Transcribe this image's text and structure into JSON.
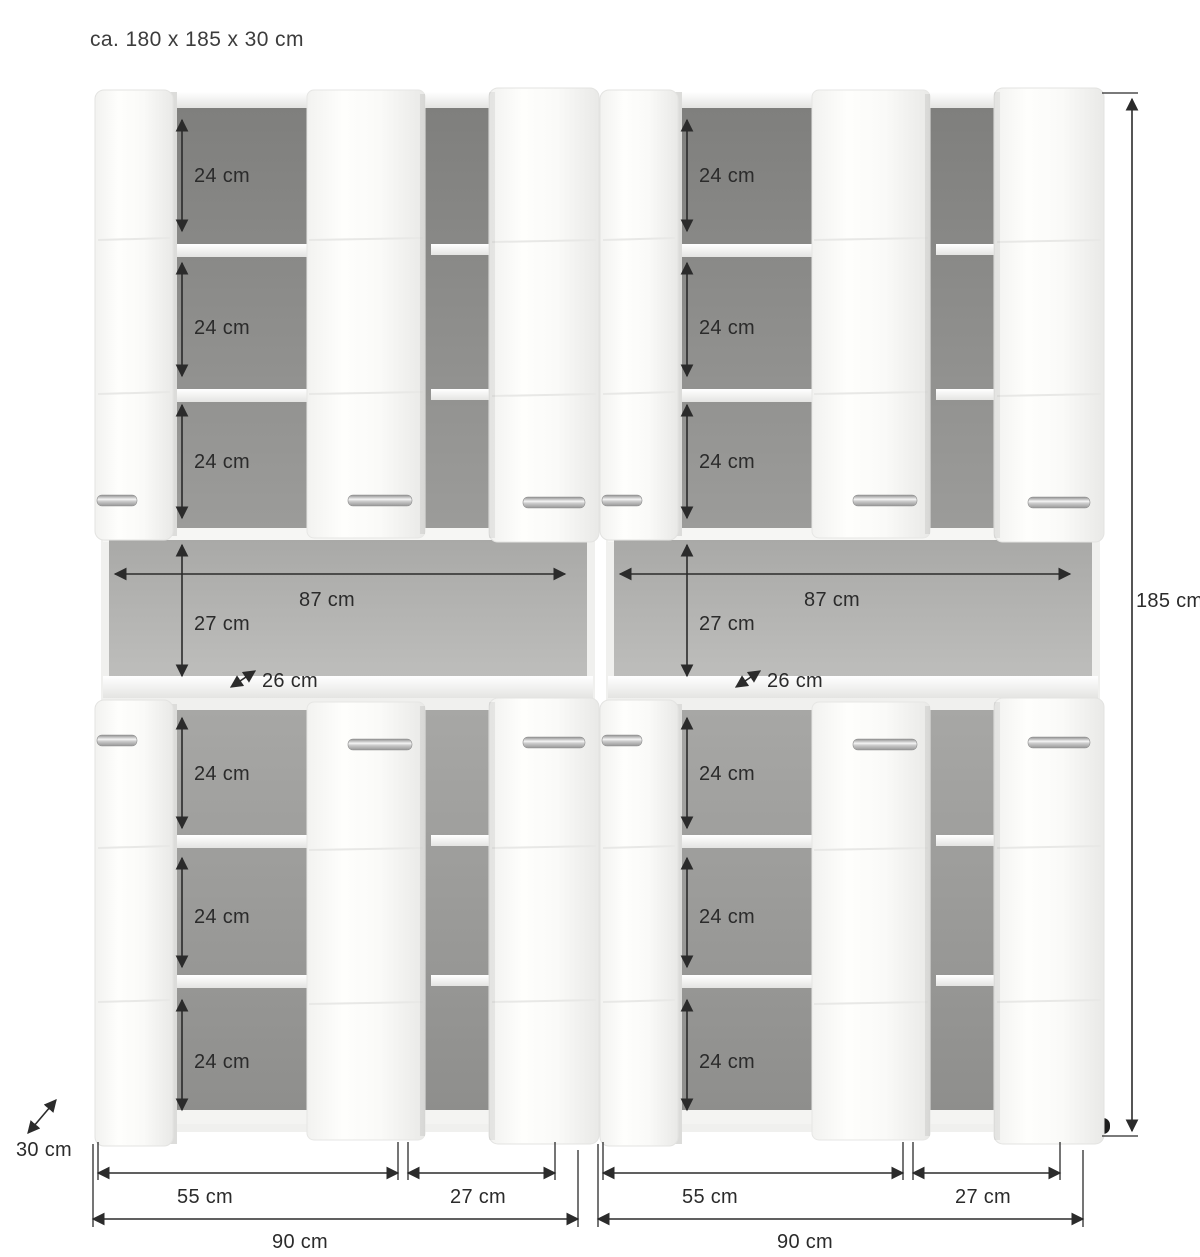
{
  "title": "ca. 180 x 185 x 30 cm",
  "dimensions": {
    "compartment_height": "24 cm",
    "niche_width": "87 cm",
    "niche_height": "27 cm",
    "niche_depth": "26 cm",
    "door_section_width": "55 cm",
    "side_section_width": "27 cm",
    "unit_width": "90 cm",
    "overall_height": "185 cm",
    "overall_depth": "30 cm"
  },
  "colors": {
    "background": "#ffffff",
    "dimension_ink": "#2b2b2b",
    "cabinet_white": "#f0f0ee",
    "door_white": "#fdfdfb",
    "interior_gray_top": "#8c8c8a",
    "interior_gray_bottom": "#9e9e9c",
    "niche_gray": "#b4b4b2",
    "shelf_white": "#f4f4f2",
    "handle_chrome": "#d6d6d4",
    "foot_black": "#1d1d1d"
  }
}
